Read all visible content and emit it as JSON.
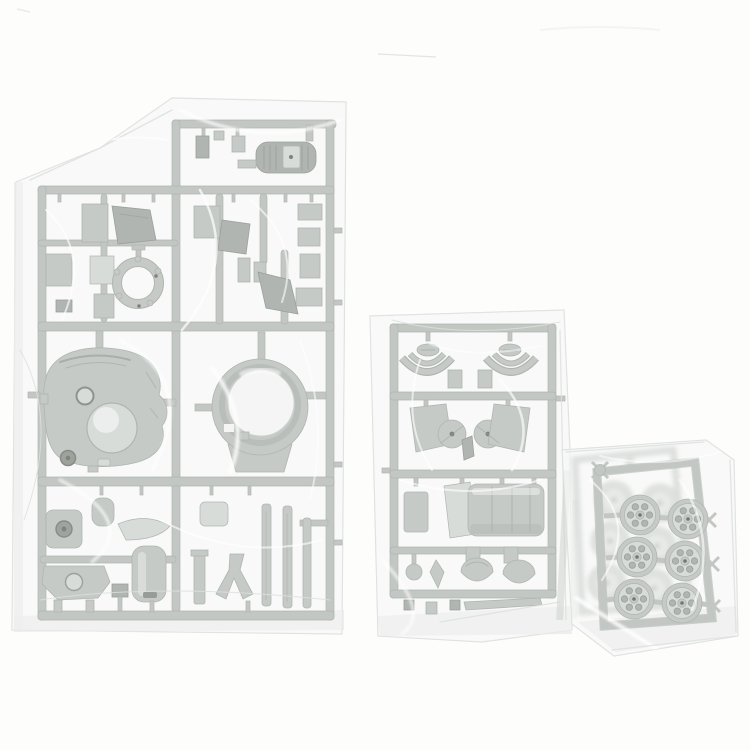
{
  "scene": {
    "type": "photograph",
    "description": "Three sealed clear plastic bags of unassembled gray model-kit sprues (injection-molded runners with tank parts) photographed on a plain white background",
    "background": "plain white surface"
  },
  "objects": {
    "large_sprue": {
      "label": "large L-shaped parts runner in sealed clear bag",
      "notable_parts": [
        "ribbed engine block with light center plate",
        "rectangular hatch and plate parts",
        "small ring with lugs and dark rivets",
        "turret shell with hatch ring, dome and dark periscope",
        "large turret-ring casting with open center and skirt tab",
        "mantlet block with round bore",
        "rounded canister with dark slot",
        "hull fitting with circular opening",
        "Y-shaped tow bracket",
        "three long flat rods"
      ]
    },
    "medium_sprue": {
      "label": "rectangular runner in sealed clear bag",
      "notable_parts": [
        "two pin-mounted oval caps",
        "two pairs of curved fender braces",
        "two angled side plates with round discs and dark hubs",
        "curved plate and wide ribbed cylinder section",
        "ball part, kite bracket and two dome hatches",
        "small blocks and a thin strip along the bottom"
      ]
    },
    "wheel_sprues": {
      "label": "two stacked, tilted runners of spoked road wheels in a clear bag",
      "visible_front_wheels": 6,
      "blurred_back_wheels": 6,
      "spokes_per_wheel": 6
    }
  },
  "colors": {
    "bg": "#fdfdfc",
    "plastic": "#b5bbb6",
    "plasticDark": "#9aa19c",
    "plasticDarker": "#7f867f",
    "plasticLight": "#cdd2ce",
    "rail": "#b2b8b4",
    "railEdge": "#9aa19c",
    "holeDark": "#5a605c",
    "bagFill": "#f3f5f3",
    "bagLine": "#dde1de",
    "bagShadow": "#e8eae8"
  }
}
